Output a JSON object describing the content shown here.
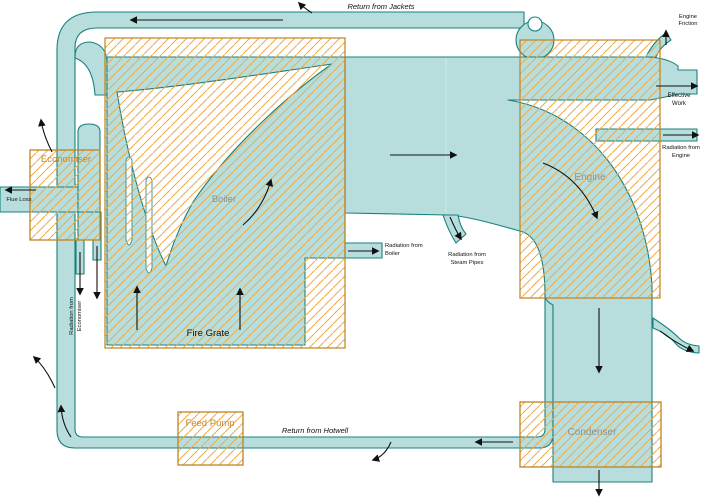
{
  "diagram_type": "steam-plant-energy-sankey",
  "colors": {
    "flow_fill": "#b7dedd",
    "flow_stroke": "#1a807e",
    "hatch": "#edaa45",
    "box_border": "#bf8222",
    "component_label": "#909090",
    "hatched_label": "#c8872a",
    "arrow": "#111111"
  },
  "components": {
    "boiler": "Boiler",
    "fire_grate": "Fire Grate",
    "engine": "Engine",
    "condenser": "Condenser",
    "economiser": "Economiser",
    "feed_pump": "Feed Pump"
  },
  "flows": {
    "return_from_jackets": "Return from Jackets",
    "return_from_hotwell": "Return from Hotwell",
    "flue_loss": "Flue Loss",
    "engine_friction": {
      "line1": "Engine",
      "line2": "Friction"
    },
    "effective_work": {
      "line1": "Effective",
      "line2": "Work"
    },
    "radiation_from_engine": {
      "line1": "Radiation from",
      "line2": "Engine"
    },
    "radiation_from_boiler": {
      "line1": "Radiation from",
      "line2": "Boiler"
    },
    "radiation_from_steam_pipes": {
      "line1": "Radiation from",
      "line2": "Steam Pipes"
    },
    "radiation_from_economiser": {
      "line1": "Radiation from",
      "line2": "Economiser"
    }
  }
}
